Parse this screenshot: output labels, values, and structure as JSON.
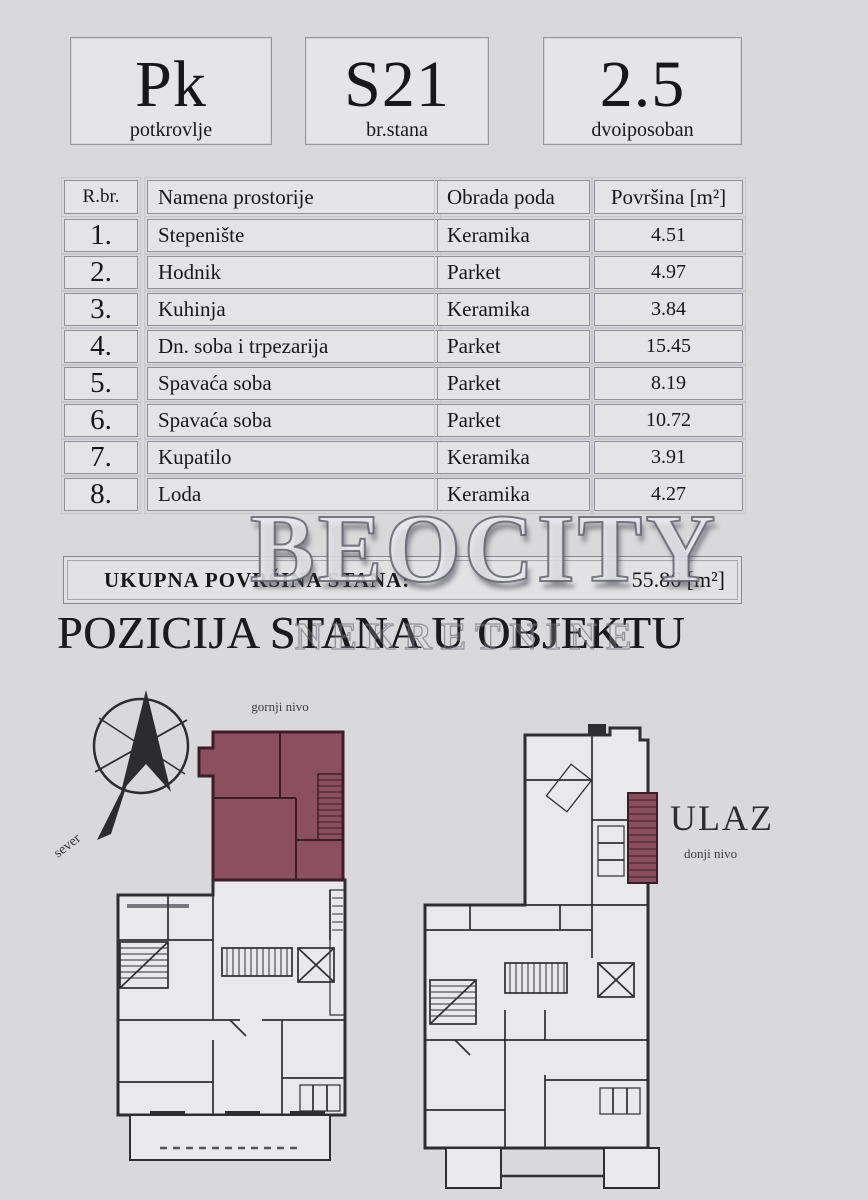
{
  "header": {
    "boxes": [
      {
        "value": "Pk",
        "label": "potkrovlje"
      },
      {
        "value": "S21",
        "label": "br.stana"
      },
      {
        "value": "2.5",
        "label": "dvoiposoban"
      }
    ]
  },
  "table": {
    "columns": {
      "num": "R.br.",
      "name": "Namena prostorije",
      "floor": "Obrada poda",
      "area": "Površina [m²]"
    },
    "rows": [
      {
        "num": "1.",
        "name": "Stepenište",
        "floor": "Keramika",
        "area": "4.51"
      },
      {
        "num": "2.",
        "name": "Hodnik",
        "floor": "Parket",
        "area": "4.97"
      },
      {
        "num": "3.",
        "name": "Kuhinja",
        "floor": "Keramika",
        "area": "3.84"
      },
      {
        "num": "4.",
        "name": "Dn. soba i trpezarija",
        "floor": "Parket",
        "area": "15.45"
      },
      {
        "num": "5.",
        "name": "Spavaća soba",
        "floor": "Parket",
        "area": "8.19"
      },
      {
        "num": "6.",
        "name": "Spavaća soba",
        "floor": "Parket",
        "area": "10.72"
      },
      {
        "num": "7.",
        "name": "Kupatilo",
        "floor": "Keramika",
        "area": "3.91"
      },
      {
        "num": "8.",
        "name": "Loda",
        "floor": "Keramika",
        "area": "4.27"
      }
    ],
    "total_label": "UKUPNA POVRŠINA STANA:",
    "total_value": "55.86 [m²]"
  },
  "watermark": {
    "title": "BEOCITY",
    "subtitle": "NEKRETNINE"
  },
  "section": {
    "title": "POZICIJA STANA U OBJEKTU"
  },
  "plans": {
    "upper_label": "gornji nivo",
    "entrance_label": "ULAZ",
    "lower_label": "donji nivo",
    "compass_label": "sever",
    "highlight_color": "#8c4f5f"
  }
}
